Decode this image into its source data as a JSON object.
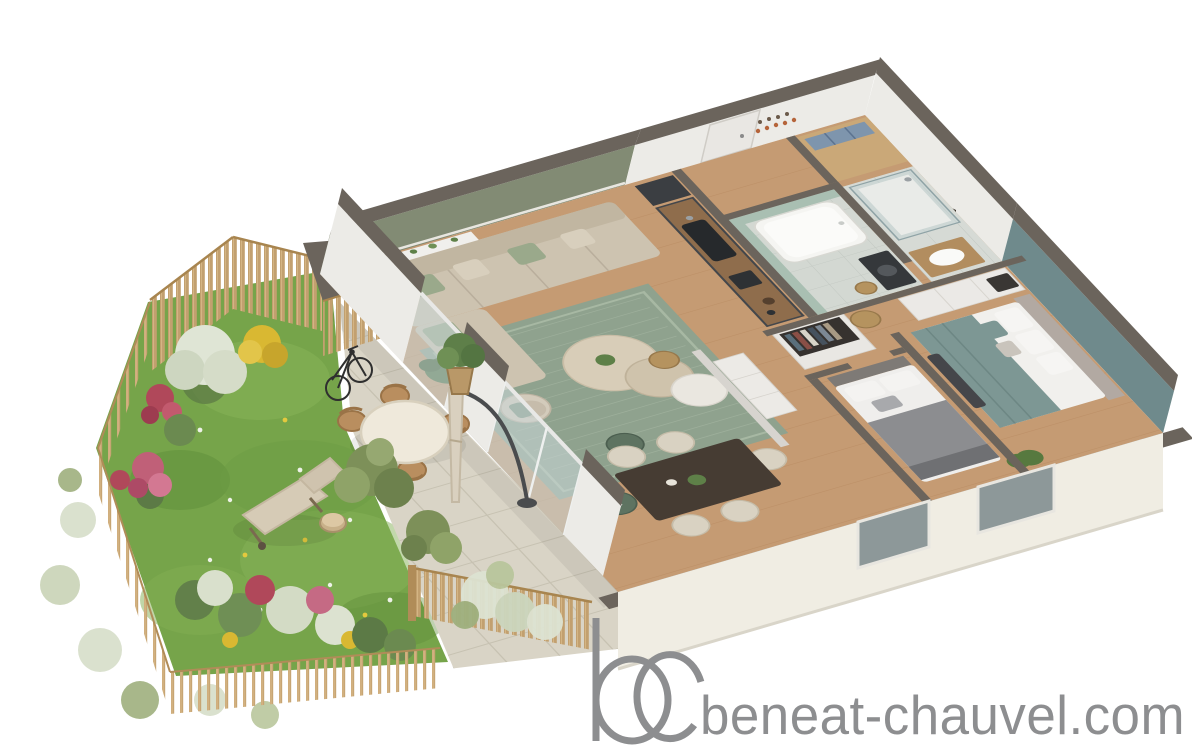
{
  "watermark": {
    "site_text": "beneat-chauvel.com",
    "logo_letters": "bc",
    "color": "#8d8e90"
  },
  "palette": {
    "background": "#ffffff",
    "wall_top": "#6b645c",
    "exterior_face": "#f0ede3",
    "interior_white": "#ecebe7",
    "sage_wall": "#828b74",
    "teal_wall": "#6f8a8c",
    "wood_floor": "#c59b73",
    "tile_floor": "#d3d8d2",
    "rug": "#8fa28e",
    "sofa": "#cdc3b0",
    "pillow_green": "#9aa98b",
    "kitchen_cabinet": "#44474b",
    "counter_wood": "#8f6d4c",
    "bath_tile": "#a9bfb2",
    "bed_teal": "#7d9794",
    "bed_gray": "#8c8d90",
    "lawn": "#76a44a",
    "terrace": "#d9d4c6",
    "fence_wood": "#c2a06f",
    "plant_red": "#b0485a",
    "plant_pink": "#c56a84",
    "plant_yellow": "#d9b832",
    "plant_silver": "#dde3d2",
    "plant_green": "#5c7a46"
  },
  "scene": {
    "type": "3d-floor-plan-render",
    "areas": [
      "garden",
      "terrace",
      "storage-shed",
      "living-dining-room",
      "kitchen",
      "entry-hall",
      "bathroom",
      "shower-room",
      "hallway",
      "bedroom-1",
      "bedroom-2"
    ],
    "garden_elements": [
      "lawn",
      "slat-fence",
      "picket-fence",
      "flower-beds",
      "deck-chair",
      "tree-stump-table",
      "bicycle",
      "round-outdoor-table",
      "wood-chairs",
      "closed-parasol",
      "potted-plants",
      "olive-shrubs",
      "ornamental-grasses"
    ],
    "interior_elements": [
      "corner-sofa",
      "wall-shelf-with-plants",
      "area-rug",
      "coffee-tables",
      "pouf",
      "armchair",
      "dining-table-with-chairs",
      "kitchen-counter-with-sink",
      "coat-hooks",
      "bathtub",
      "washing-machine",
      "walk-in-shower",
      "vanity",
      "open-wardrobe",
      "wicker-baskets",
      "master-bed",
      "second-bed",
      "closets"
    ]
  }
}
